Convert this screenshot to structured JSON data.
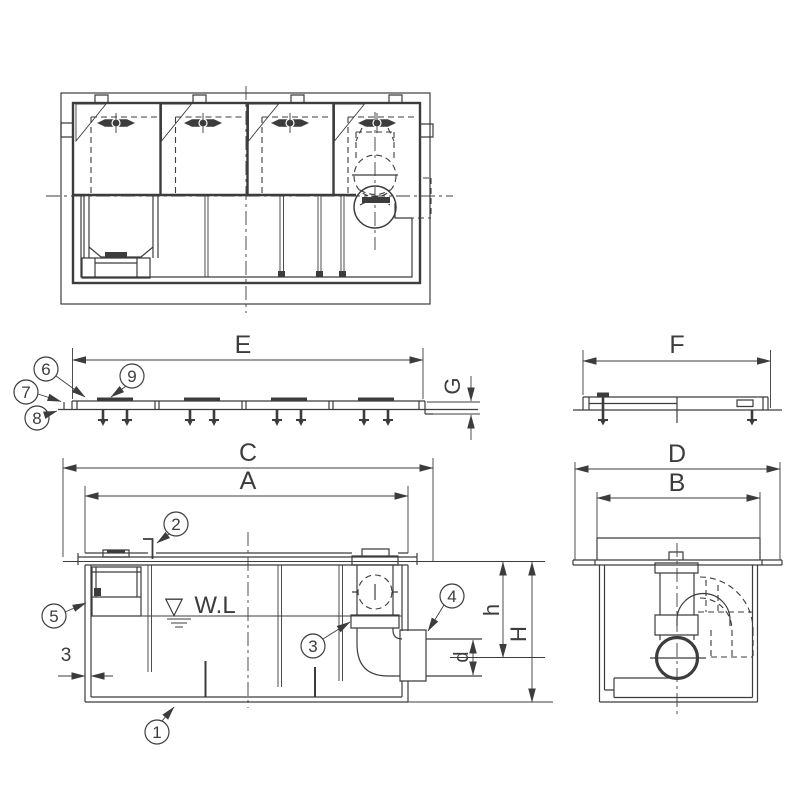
{
  "drawing": {
    "background": "#ffffff",
    "line_color": "#3c3c3c",
    "dimension_labels": {
      "E": "E",
      "F": "F",
      "G": "G",
      "C": "C",
      "A": "A",
      "D": "D",
      "B": "B",
      "h": "h",
      "H": "H",
      "d": "d",
      "wall_thickness": "3"
    },
    "water_level": {
      "symbol": "▽",
      "label": "W.L"
    },
    "callouts": {
      "1": "1",
      "2": "2",
      "3": "3",
      "4": "4",
      "5": "5",
      "6": "6",
      "7": "7",
      "8": "8",
      "9": "9"
    }
  }
}
